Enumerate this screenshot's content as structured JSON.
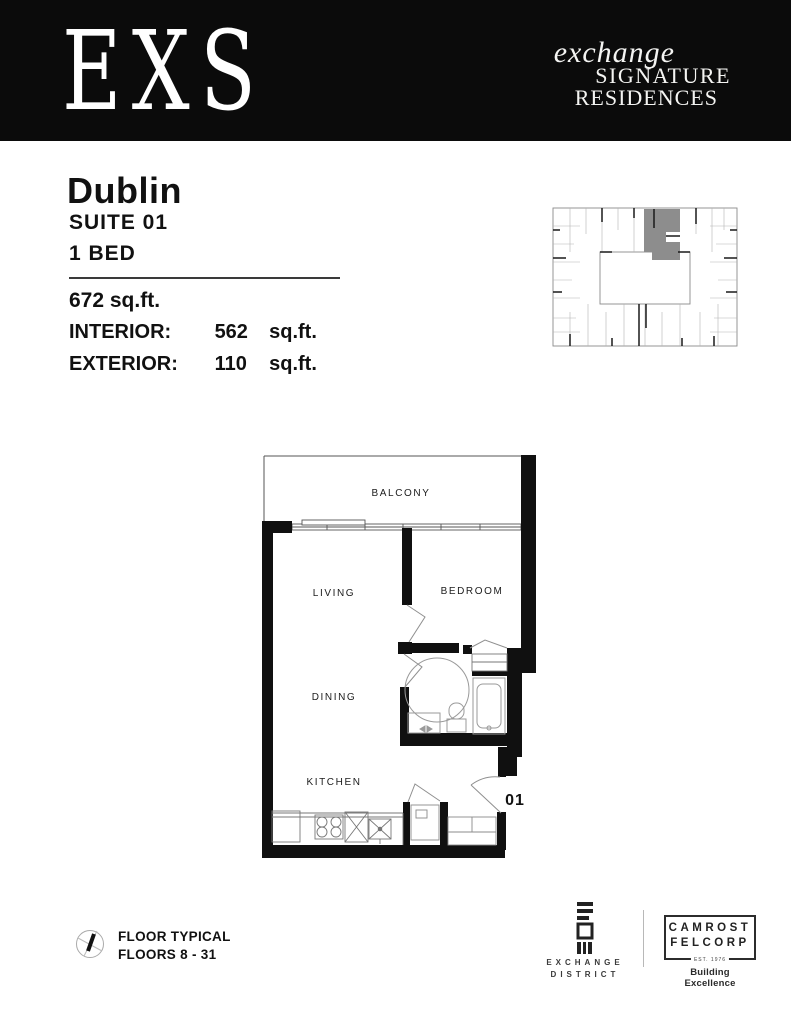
{
  "header": {
    "logo": "EXS",
    "brand_line1": "exchange",
    "brand_line2": "SIGNATURE",
    "brand_line3": "RESIDENCES",
    "background": "#0b0b0b"
  },
  "suite": {
    "name": "Dublin",
    "suite_number_label": "SUITE 01",
    "bedroom_label": "1 BED",
    "total_area": "672 sq.ft.",
    "interior": {
      "label": "INTERIOR:",
      "value": "562",
      "unit": "sq.ft."
    },
    "exterior": {
      "label": "EXTERIOR:",
      "value": "110",
      "unit": "sq.ft."
    }
  },
  "floor_plan": {
    "balcony_label": "BALCONY",
    "living_label": "LIVING",
    "bedroom_label": "BEDROOM",
    "dining_label": "DINING",
    "kitchen_label": "KITCHEN",
    "unit_number": "01",
    "keyplan_highlight_color": "#8d8d8d"
  },
  "footer": {
    "floor_note_line1": "FLOOR TYPICAL",
    "floor_note_line2": "FLOORS 8 - 31",
    "exchange_district_line1": "EXCHANGE",
    "exchange_district_line2": "DISTRICT",
    "camrost_line1": "CAMROST",
    "camrost_line2": "FELCORP",
    "camrost_est": "EST. 1976",
    "camrost_tagline": "Building Excellence"
  }
}
